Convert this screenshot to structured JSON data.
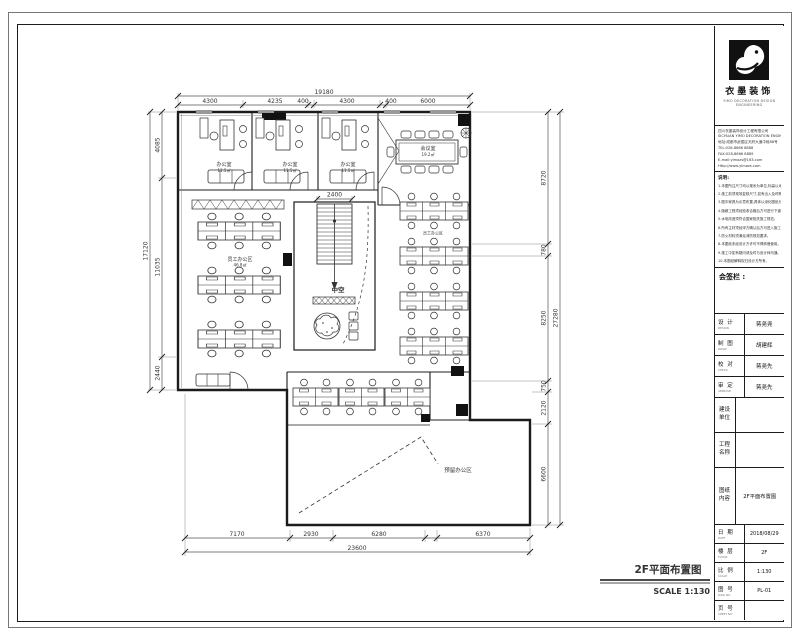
{
  "sheet": {
    "drawing_title": "2F平面布置图",
    "scale_label": "SCALE 1:130"
  },
  "title_block": {
    "company": {
      "name": "衣墨装饰",
      "tagline": "YIMO DECORATION DESIGN ENGINEERING",
      "info_lines": [
        "四川衣墨装饰设计工程有限公司",
        "SICHUAN YIMO DECORATION ENGINEERING CO.,LTD",
        "地址:成都市武侯区天府大道中段88号",
        "TEL:028-8666 8888",
        "FAX:028-8666 8889",
        "E-mail:yimozs@163.com",
        "Http://www.yimozs.com"
      ]
    },
    "notes_title": "说明:",
    "notes": [
      "1.本图所注尺寸均以毫米为单位,标高以米为单位。",
      "2.施工前须现场复核尺寸,如有出入及时联系设计师。",
      "3.图中家具为示意布置,具体以深化图纸为准。",
      "4.隐蔽工程须经验收合格后方可进行下道工序。",
      "5.水电改造须符合国家相关施工规范。",
      "6.所有主材须经甲方确认后方可进入施工。",
      "7.防火材料须满足消防规范要求。",
      "8.本图纸未经设计方许可不得转借使用。",
      "9.施工中如有疑问请及时与设计师沟通。",
      "10.本图纸解释权归设计方所有。"
    ],
    "owner_label": "会签栏 :",
    "personnel": [
      {
        "label": "设 计",
        "sub": "DESIGN",
        "value": "蒋尧尧"
      },
      {
        "label": "制 图",
        "sub": "DRAW",
        "value": "胡建辉"
      },
      {
        "label": "校 对",
        "sub": "CHECK",
        "value": "蒋尧先"
      },
      {
        "label": "审 定",
        "sub": "APPROVE",
        "value": "蒋尧先"
      }
    ],
    "project_rows": [
      {
        "label": "建设单位",
        "value": ""
      },
      {
        "label": "工程名称",
        "value": ""
      },
      {
        "label": "图纸内容",
        "value": "2F平面布置图"
      }
    ],
    "meta_rows": [
      {
        "label": "日 期",
        "sub": "DATE",
        "value": "2018/08/29"
      },
      {
        "label": "楼 层",
        "sub": "FLOOR",
        "value": "2F"
      },
      {
        "label": "比 例",
        "sub": "SCALE",
        "value": "1:130"
      },
      {
        "label": "图 号",
        "sub": "DWG NO",
        "value": "PL-01"
      },
      {
        "label": "页 号",
        "sub": "SHEET NO",
        "value": ""
      }
    ]
  },
  "plan": {
    "rooms": {
      "office": {
        "name": "办公室",
        "area": "11.5㎡"
      },
      "meeting": {
        "name": "会议室",
        "area": "19.2㎡"
      },
      "staff": {
        "name": "员工办公区",
        "area": "46.8㎡"
      },
      "reserved": {
        "name": "预留办公区"
      }
    },
    "labels": {
      "void": "中空"
    },
    "dims": {
      "stair": "2400",
      "top": {
        "total": "19180",
        "segments": [
          "4300",
          "4235",
          "400",
          "4300",
          "400",
          "6000"
        ]
      },
      "left": {
        "total": "17120",
        "segments": [
          "4085",
          "11035",
          "2440"
        ]
      },
      "right": {
        "total": "27280",
        "segments": [
          "8720",
          "780",
          "8250",
          "750",
          "2120",
          "6600"
        ]
      },
      "bottom": {
        "total": "23600",
        "segments": [
          "7170",
          "2930",
          "6280",
          "6370"
        ]
      }
    }
  }
}
